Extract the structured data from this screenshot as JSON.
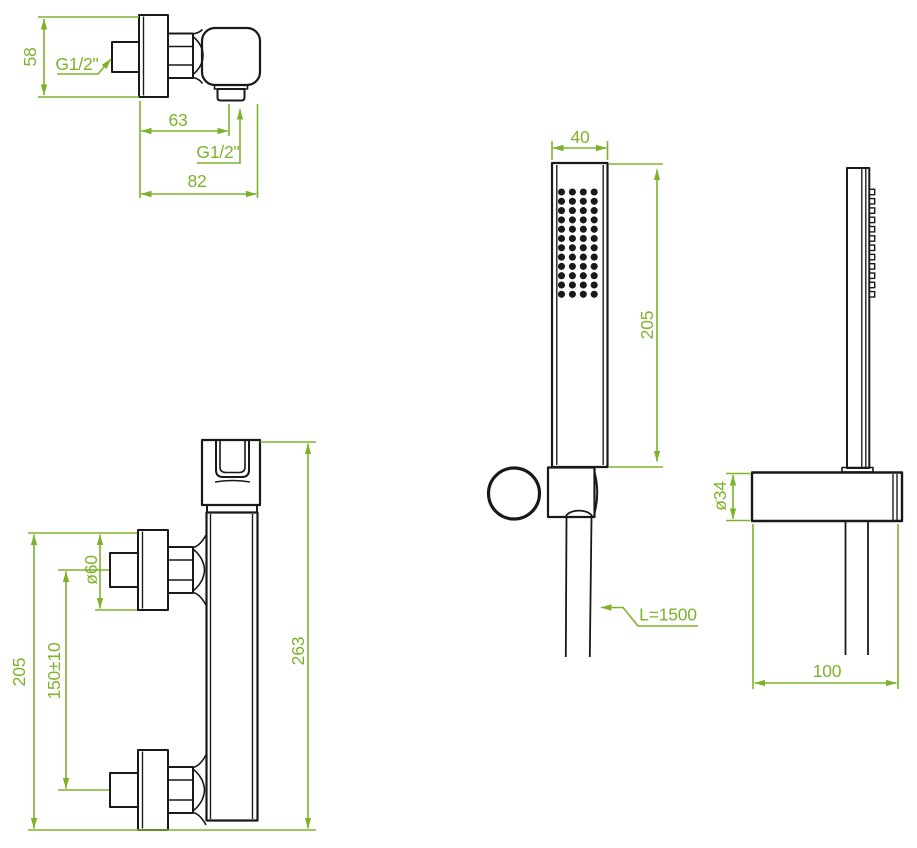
{
  "colors": {
    "dimension_green": "#7db32b",
    "line_black": "#191919",
    "background": "#ffffff"
  },
  "views": {
    "mixer_top": {
      "dim_height": "58",
      "inlet_thread": "G1/2\"",
      "dim_outlet_offset": "63",
      "outlet_thread": "G1/2\"",
      "dim_depth": "82"
    },
    "mixer_front": {
      "dim_flange_diameter": "ø60",
      "dim_connection_spacing": "150±10",
      "dim_connections_height": "205",
      "dim_total_height": "263"
    },
    "handshower_front": {
      "dim_head_width": "40",
      "dim_head_length": "205",
      "hose_length": "L=1500"
    },
    "handshower_side": {
      "dim_holder_diameter": "ø34",
      "dim_holder_depth": "100"
    }
  }
}
